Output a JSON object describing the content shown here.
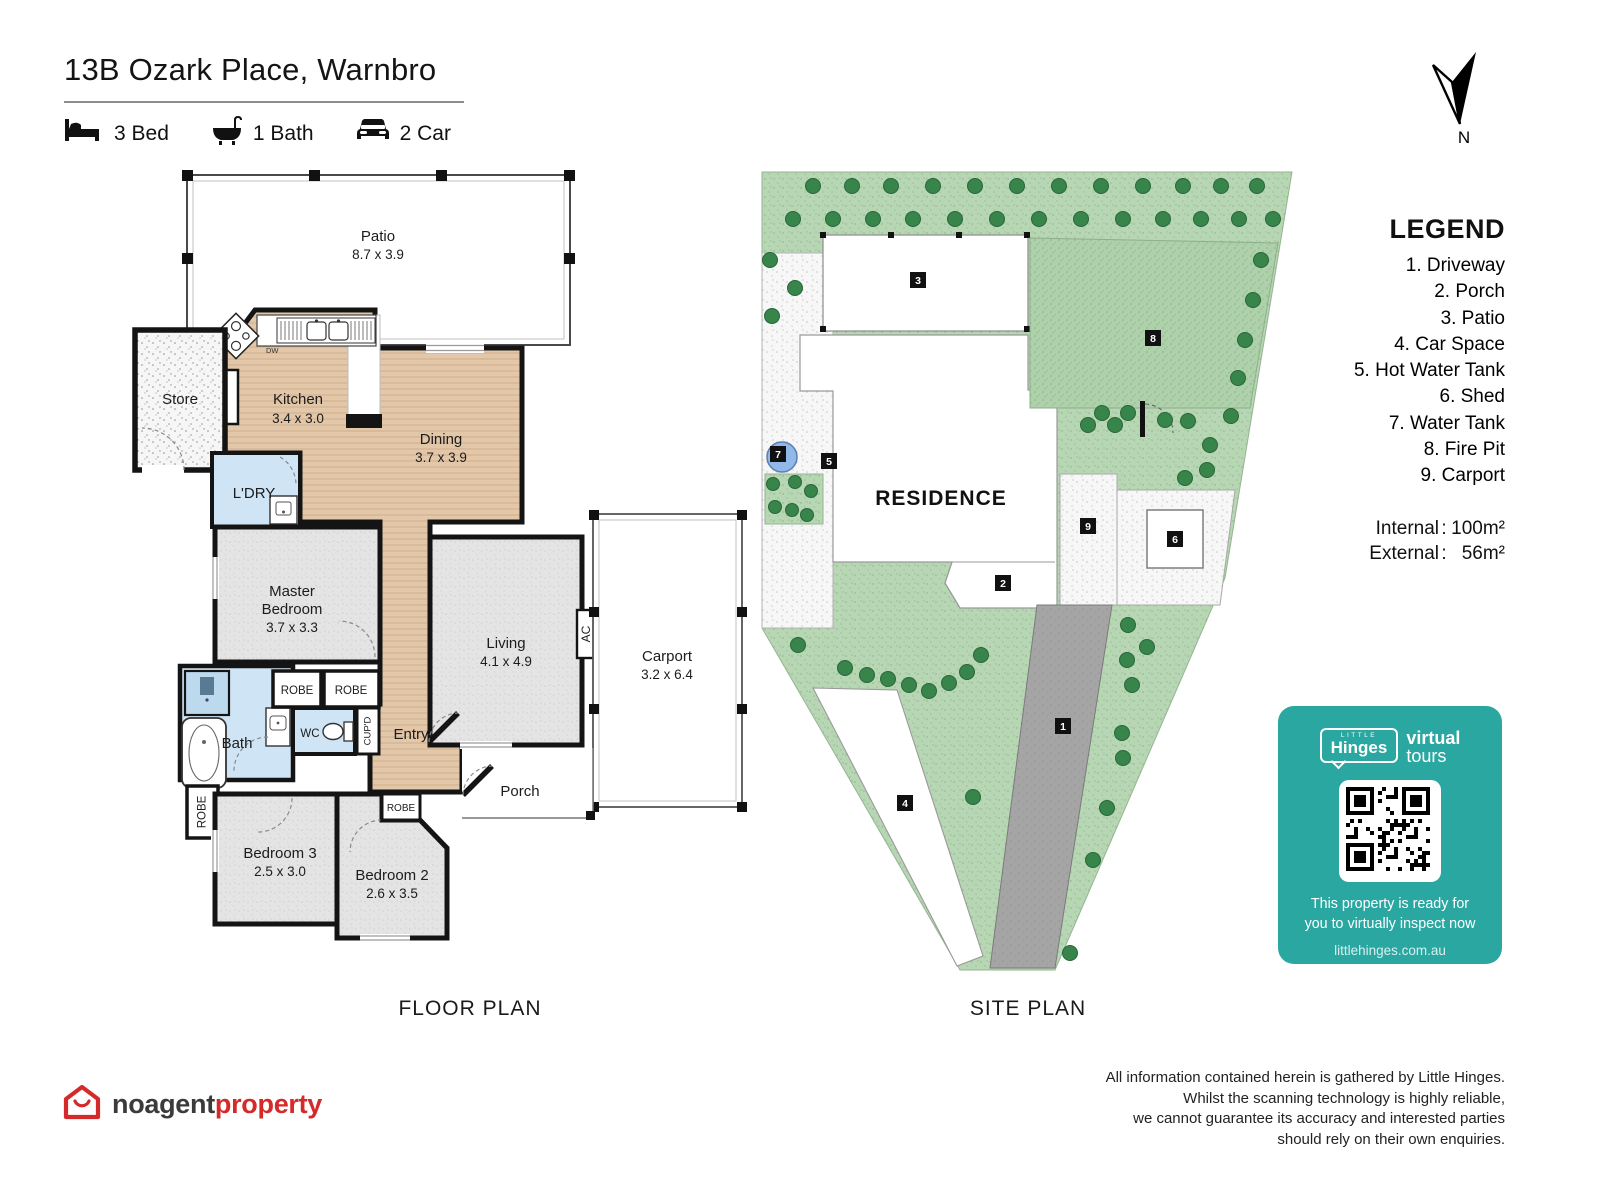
{
  "header": {
    "title": "13B Ozark Place, Warnbro",
    "features": [
      {
        "icon": "bed-icon",
        "label": "3 Bed"
      },
      {
        "icon": "bath-icon",
        "label": "1 Bath"
      },
      {
        "icon": "car-icon",
        "label": "2 Car"
      }
    ]
  },
  "compass": {
    "label": "N"
  },
  "floor_plan": {
    "caption": "FLOOR PLAN",
    "rooms": {
      "patio": {
        "name": "Patio",
        "dims": "8.7 x 3.9"
      },
      "store": "Store",
      "kitchen": {
        "name": "Kitchen",
        "dims": "3.4 x 3.0"
      },
      "pantry": "P'TRY",
      "dw": "DW",
      "dining": {
        "name": "Dining",
        "dims": "3.7 x 3.9"
      },
      "laundry": "L'DRY",
      "master": {
        "l1": "Master",
        "l2": "Bedroom",
        "dims": "3.7 x 3.3"
      },
      "living": {
        "name": "Living",
        "dims": "4.1 x 4.9"
      },
      "ac": "AC",
      "carport": {
        "name": "Carport",
        "dims": "3.2 x 6.4"
      },
      "porch": "Porch",
      "entry": "Entry",
      "bath": "Bath",
      "wc": "WC",
      "cupboard": "CUP'D",
      "robe": "ROBE",
      "bedroom3": {
        "name": "Bedroom 3",
        "dims": "2.5 x 3.0"
      },
      "bedroom2": {
        "name": "Bedroom 2",
        "dims": "2.6 x 3.5"
      }
    }
  },
  "site_plan": {
    "caption": "SITE PLAN",
    "residence": "RESIDENCE",
    "markers": {
      "m1": "1",
      "m2": "2",
      "m3": "3",
      "m4": "4",
      "m5": "5",
      "m6": "6",
      "m7": "7",
      "m8": "8",
      "m9": "9"
    }
  },
  "legend": {
    "title": "LEGEND",
    "items": [
      "1. Driveway",
      "2. Porch",
      "3. Patio",
      "4. Car Space",
      "5. Hot Water Tank",
      "6. Shed",
      "7. Water Tank",
      "8. Fire Pit",
      "9. Carport"
    ],
    "internal_label": "Internal",
    "internal_value": "100m²",
    "external_label": "External",
    "external_value": "56m²",
    "colon": ":"
  },
  "tour_card": {
    "little": "LITTLE",
    "hinges": "Hinges",
    "virtual": "virtual",
    "tours": "tours",
    "line1": "This property is ready for",
    "line2": "you to virtually inspect now",
    "website": "littlehinges.com.au"
  },
  "footer": {
    "brand1": "noagent",
    "brand2": "property",
    "disclaimer": [
      "All information contained herein is gathered by Little Hinges.",
      "Whilst the scanning technology is highly reliable,",
      "we cannot guarantee its accuracy and interested parties",
      "should rely on their own enquiries."
    ]
  },
  "colors": {
    "teal": "#2aa7a1",
    "wood_floor": "#e2c7a9",
    "carpet": "#e3e3e3",
    "wet_blue": "#cfe4f4",
    "site_green": "#b7d6b3",
    "tree_green": "#37854b",
    "driveway_gray": "#a5a5a5",
    "wall_black": "#141414",
    "brand_red": "#d42a29"
  }
}
